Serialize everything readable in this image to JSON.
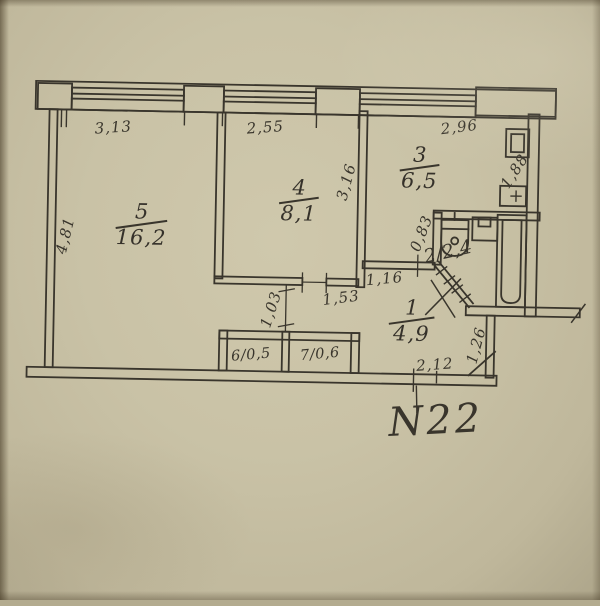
{
  "document": {
    "type_label": "apartment floor plan (scanned photo)",
    "apartment_number": "N22"
  },
  "rooms": {
    "r5": {
      "number": "5",
      "area": "16,2"
    },
    "r4": {
      "number": "4",
      "area": "8,1"
    },
    "r3": {
      "number": "3",
      "area": "6,5"
    },
    "r1": {
      "number": "1",
      "area": "4,9"
    },
    "r2": {
      "label": "2/2,4"
    },
    "r6": {
      "label": "6/0,5"
    },
    "r7": {
      "label": "7/0,6"
    }
  },
  "dimensions": {
    "top_room5": "3,13",
    "top_room4": "2,55",
    "top_room3": "2,96",
    "left_room5": "4,81",
    "room4_right_wall": "3,16",
    "kitchen_right_wall": "1,88",
    "bath_left_wall": "0,83",
    "passage_width": "1,03",
    "hall_wall_west": "1,53",
    "hall_wall_north": "1,16",
    "hall_right_wall": "1,26",
    "bottom_wall": "2,12"
  },
  "colors": {
    "paper": "#c9c2a6",
    "ink": "#39352c"
  }
}
